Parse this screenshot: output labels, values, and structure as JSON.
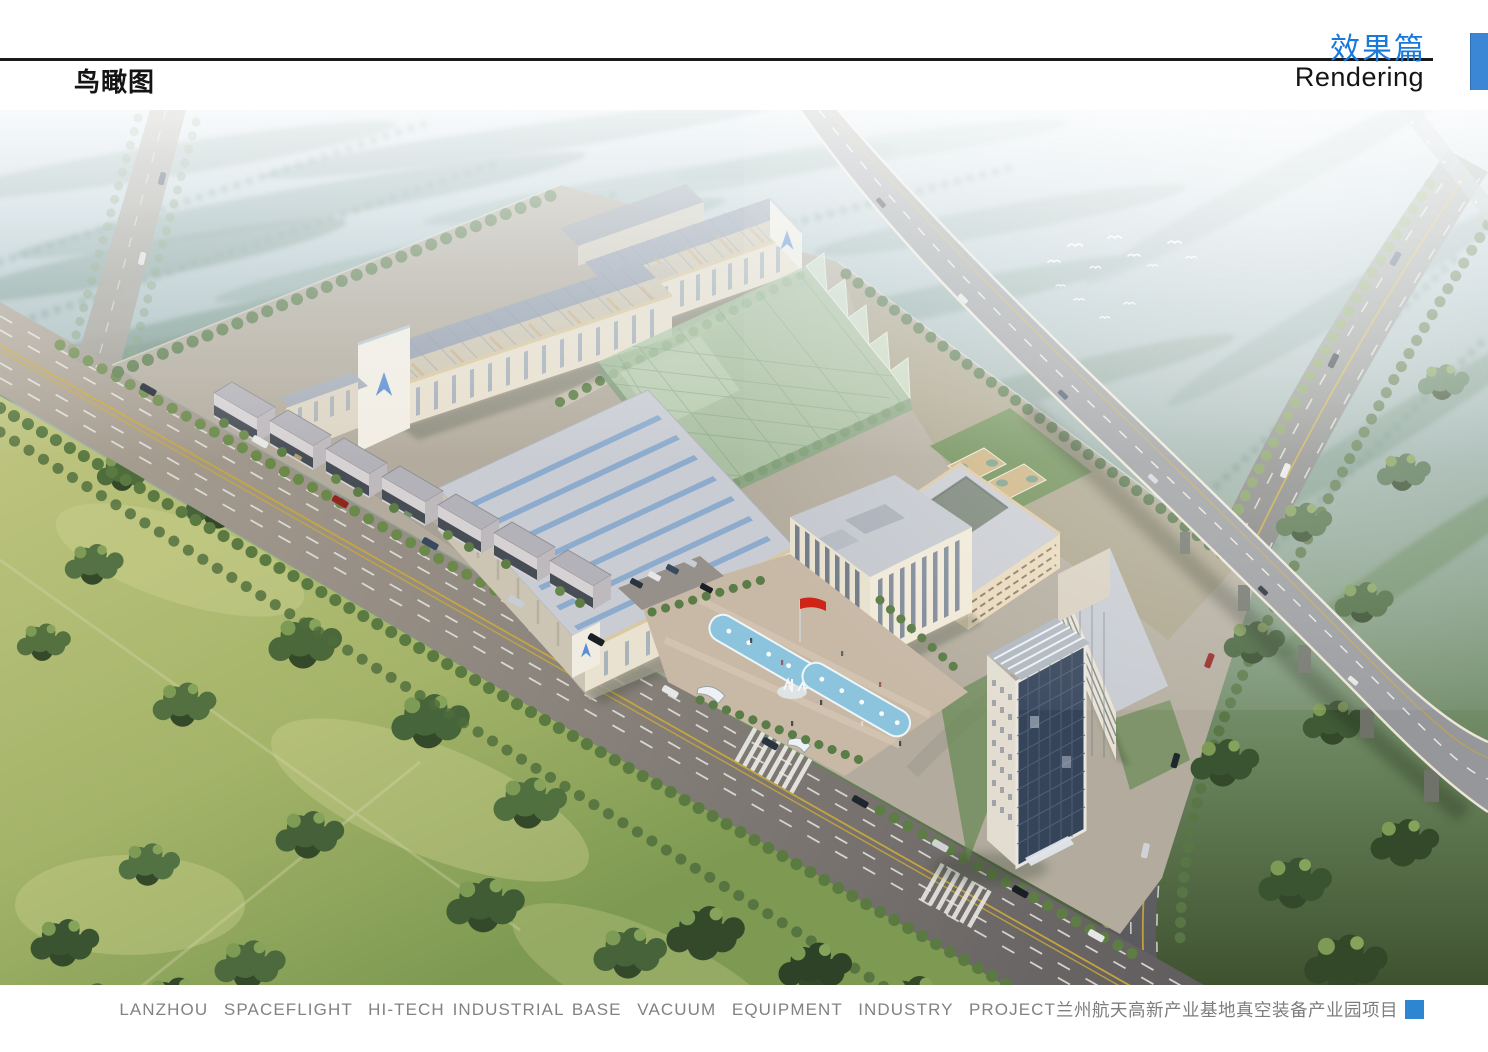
{
  "page": {
    "width": 1488,
    "height": 1052,
    "background": "#ffffff"
  },
  "header": {
    "page_label_cn": "鸟瞰图",
    "section_title_cn": "效果篇",
    "section_title_en": "Rendering",
    "accent_color": "#1878dc",
    "tab_color": "#3b87d6",
    "rule_color": "#1a1a1a"
  },
  "footer": {
    "caption_en": "LANZHOU  SPACEFLIGHT  HI-TECH INDUSTRIAL BASE  VACUUM  EQUIPMENT  INDUSTRY  PROJECT",
    "caption_cn": "兰州航天高新产业基地真空装备产业园项目",
    "text_color": "#828282",
    "marker_color": "#2e86d3"
  },
  "rendering": {
    "type": "aerial-birdseye-architectural-rendering",
    "description": "Bird's-eye rendering of the Lanzhou Spaceflight Hi-Tech Industrial Base vacuum equipment industry park: long factory workshops with skylight roofs and blue arrow logos, a translucent green glass workshop, a large warehouse, street-front shop rows, a cream office headquarters with entrance canopy, a courtyard office block, basketball courts, an east slab building, a high-rise glass tower, an entrance plaza with twin fountain pools, white sculpture and a red flag, tree-lined boulevards with traffic, farmland with tree clusters, dark woods, an elevated expressway viaduct crossing to the lower right, and white birds over hazy fields at the upper right.",
    "features": [
      "hazy-distant-fields",
      "farmland",
      "tree-clusters",
      "dark-woods",
      "main-boulevard",
      "feeder-road",
      "east-road",
      "expressway-viaduct",
      "viaduct-piers",
      "factory-workshop-rear",
      "factory-workshop-1",
      "factory-workshop-2",
      "green-glass-workshop",
      "large-warehouse",
      "street-front-shops",
      "office-headquarters",
      "entrance-canopy",
      "courtyard-office-block",
      "basketball-courts",
      "east-slab-building",
      "highrise-tower",
      "entrance-plaza",
      "fountain-pools",
      "plaza-sculpture",
      "red-flag",
      "entrance-gates",
      "parking-lot",
      "street-trees",
      "cars",
      "white-birds",
      "company-logo-gables"
    ],
    "palette": {
      "sky_haze": "#d7e3ea",
      "distant_forest": "#8fa8a4",
      "field_green": "#b4bd7a",
      "dark_forest": "#3c5531",
      "road_gray": "#8d867e",
      "building_cream": "#e9e1cf",
      "roof_blue_gray": "#97a0ae",
      "glass_green": "#a9c6a2",
      "tower_glass_blue": "#36445a",
      "pool_blue": "#8cc4de",
      "flag_red": "#cf2418",
      "logo_blue": "#5b8ed2"
    }
  }
}
